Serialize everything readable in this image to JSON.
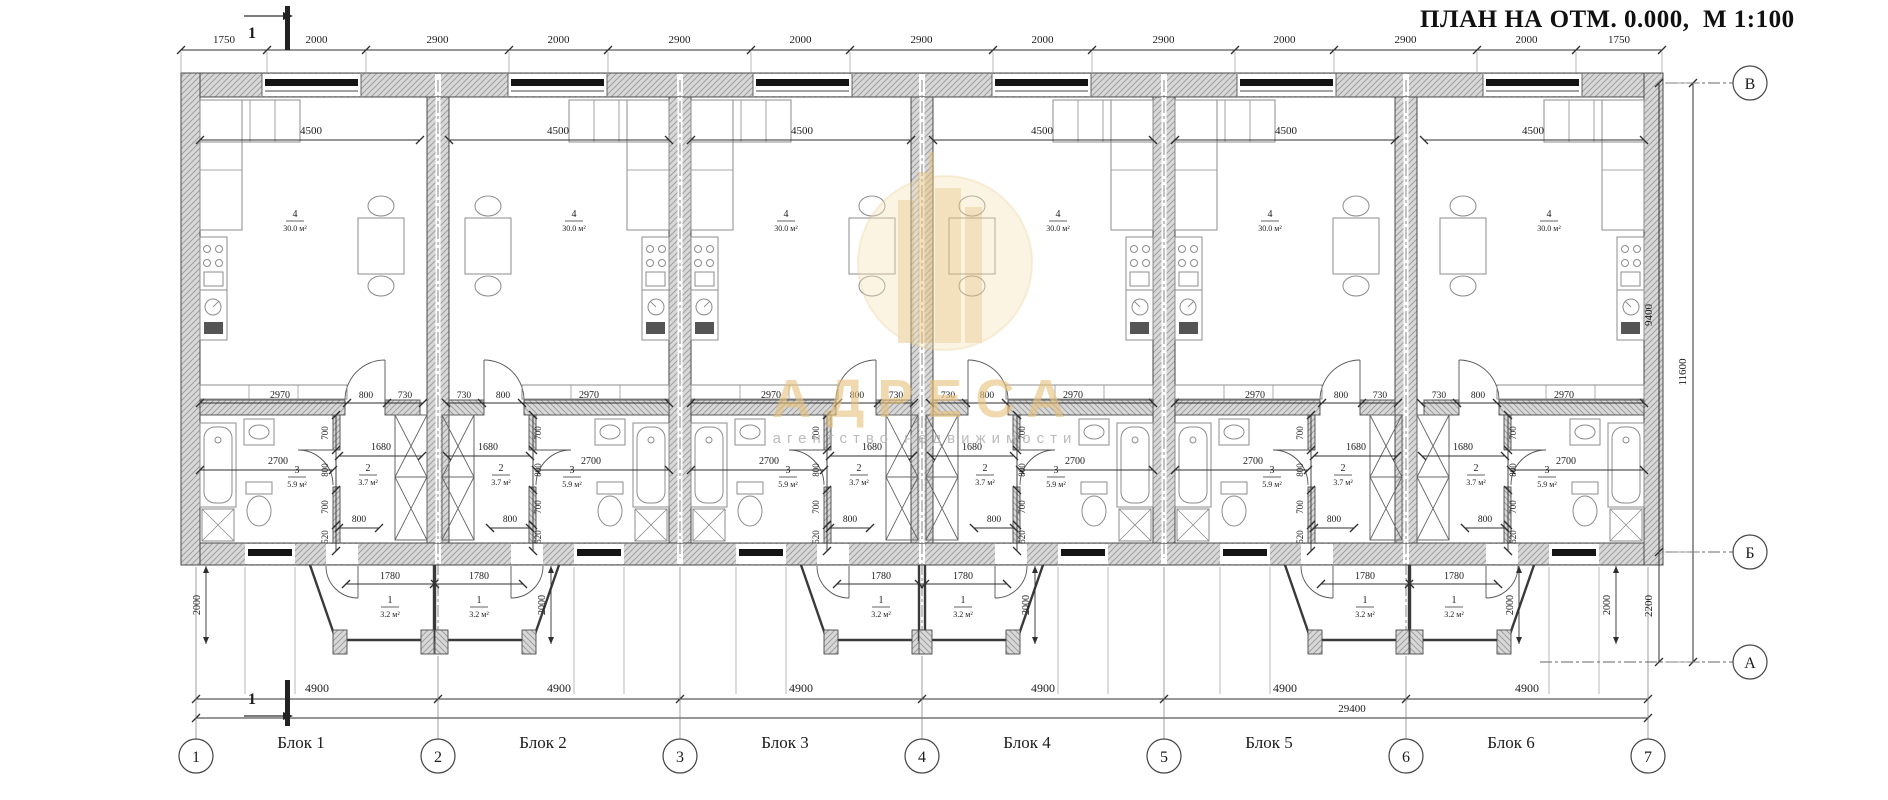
{
  "title": "ПЛАН НА ОТМ. 0.000,  М 1:100",
  "watermark": {
    "brand": "АДРЕСА",
    "subtitle": "агентство недвижимости"
  },
  "section_mark": "1",
  "axes": {
    "bottom": [
      "1",
      "2",
      "3",
      "4",
      "5",
      "6",
      "7"
    ],
    "right": [
      "В",
      "Б",
      "А"
    ]
  },
  "blocks": [
    {
      "label": "Блок 1"
    },
    {
      "label": "Блок 2"
    },
    {
      "label": "Блок 3"
    },
    {
      "label": "Блок 4"
    },
    {
      "label": "Блок 5"
    },
    {
      "label": "Блок 6"
    }
  ],
  "rooms": [
    {
      "num": "4",
      "area": "30.0 м²"
    },
    {
      "num": "2",
      "area": "3.7 м²"
    },
    {
      "num": "3",
      "area": "5.9 м²"
    },
    {
      "num": "1",
      "area": "3.2 м²"
    }
  ],
  "dims": {
    "top_chain": [
      "1750",
      "2000",
      "2900",
      "2000",
      "2900",
      "2000",
      "2900",
      "2000",
      "2900",
      "2000",
      "2900",
      "2000",
      "1750"
    ],
    "block_span": "4900",
    "total_width": "29400",
    "right_side": {
      "upper": "9400",
      "lower": "2200",
      "total": "11600"
    },
    "porch_depth": "2000",
    "block": {
      "living_width": "4500",
      "kitchen_run": "2970",
      "living_door": "800",
      "stair_opening": "730",
      "hall_width": "1680",
      "bath_width": "2700",
      "bath_door": "800",
      "porch_width": "1780",
      "wall_chain": [
        "700",
        "800",
        "700",
        "520"
      ]
    }
  },
  "colors": {
    "line": "#2f2f2f",
    "furniture": "#8c8c8c",
    "wall_fill": "#d8d8d8",
    "hatch": "#9f9f9f",
    "frame_black": "#141414",
    "gold": "#e6c27c",
    "gold_light": "#f4e2b2"
  }
}
